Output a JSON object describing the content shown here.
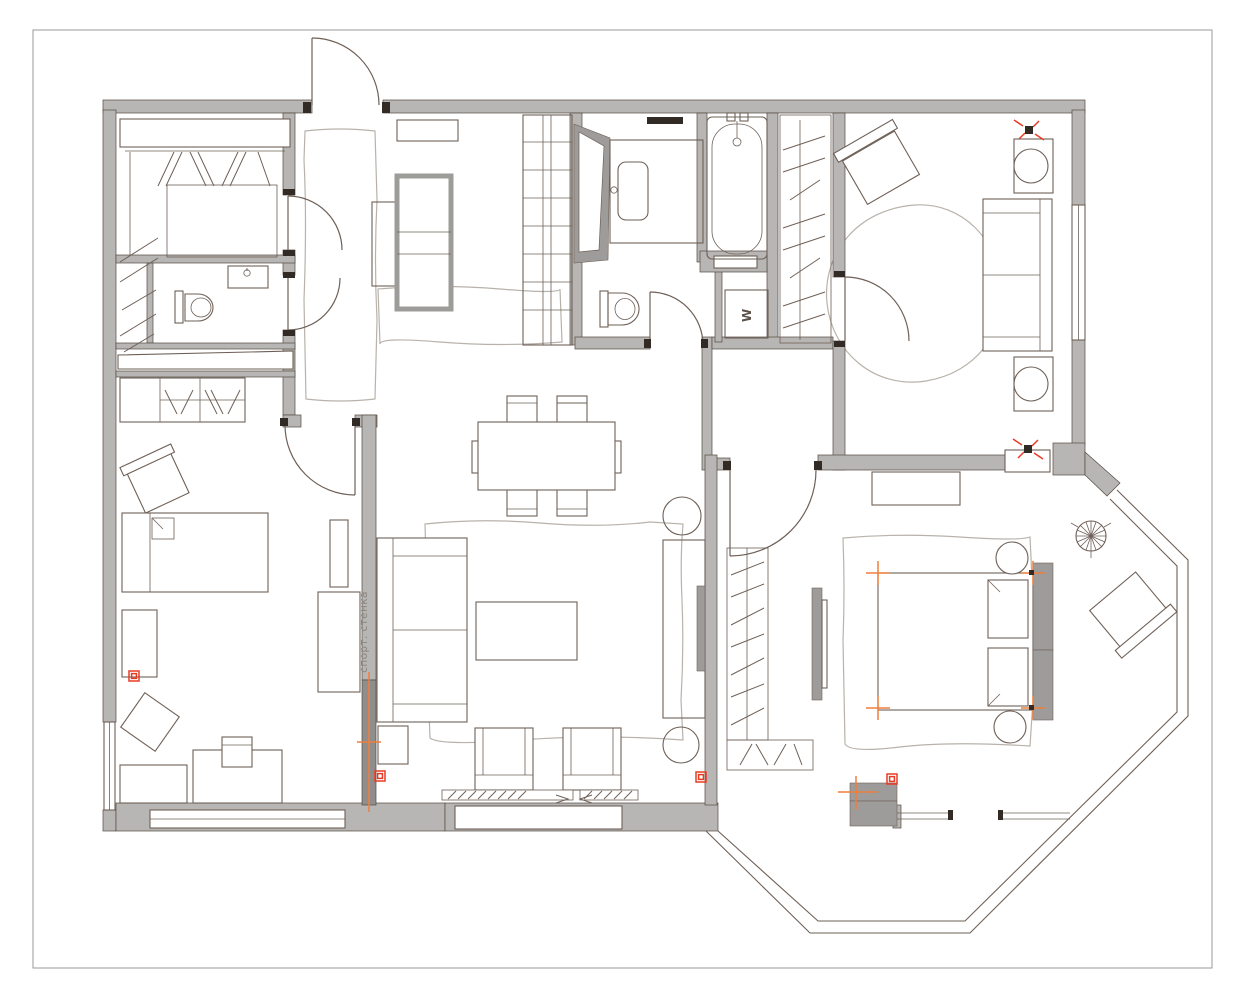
{
  "canvas": {
    "width": 1246,
    "height": 1000
  },
  "palette": {
    "wall": "#b7b6b4",
    "wall_dark": "#8f8e8c",
    "wall_stroke": "#55493f",
    "furniture_stroke": "#6e6057",
    "rug_stroke": "#b8b2ab",
    "panel_gray": "#9d9c9a",
    "jamb": "#322a24",
    "accent_red": "#e83b24",
    "accent_orange": "#ef7f3c",
    "page_border": "#9a9a9a"
  },
  "labels": {
    "sport_wall": "спорт. стенка",
    "washer": "W"
  }
}
